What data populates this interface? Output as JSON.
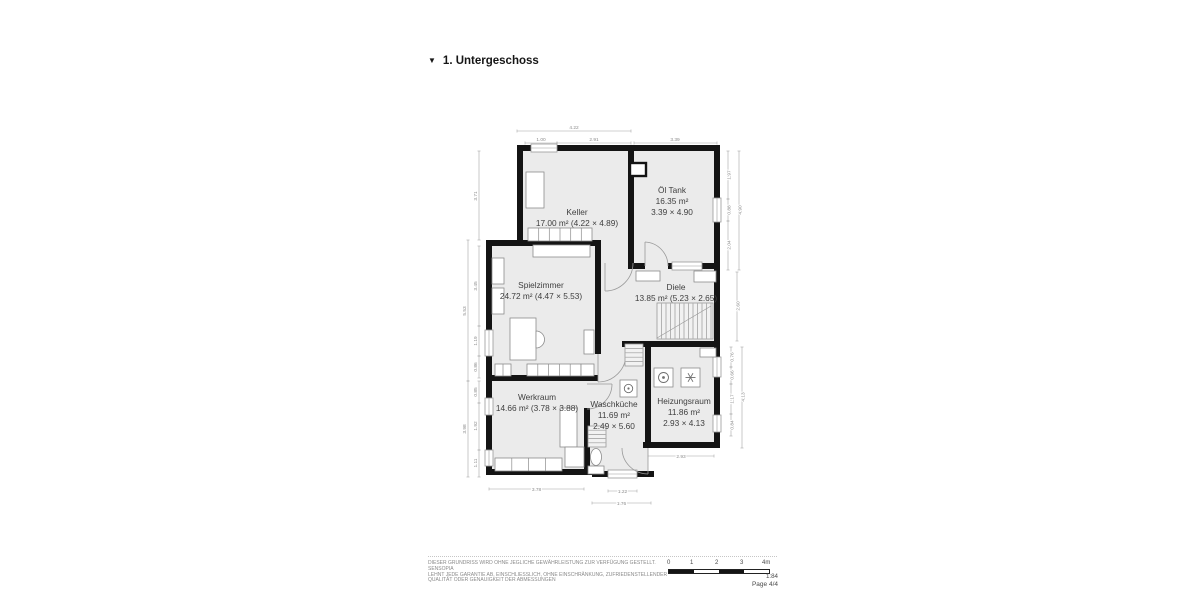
{
  "header": {
    "collapse_icon": "▼",
    "title": "1. Untergeschoss"
  },
  "rooms": {
    "keller": {
      "name": "Keller",
      "details": "17.00 m² (4.22 × 4.89)"
    },
    "oel_tank": {
      "name": "Öl Tank",
      "area": "16.35 m²",
      "size": "3.39 × 4.90"
    },
    "spielzimmer": {
      "name": "Spielzimmer",
      "details": "24.72 m² (4.47 × 5.53)"
    },
    "diele": {
      "name": "Diele",
      "details": "13.85 m² (5.23 × 2.65)"
    },
    "werkraum": {
      "name": "Werkraum",
      "details": "14.66 m² (3.78 × 3.88)"
    },
    "waschkueche": {
      "name": "Waschküche",
      "area": "11.69 m²",
      "size": "2.49 × 5.60"
    },
    "heizungsraum": {
      "name": "Heizungsraum",
      "area": "11.86 m²",
      "size": "2.93 × 4.13"
    }
  },
  "dimensions": {
    "top": {
      "overall": "4.22",
      "window": "1.00",
      "keller_rest": "2.91",
      "oel_tank": "3.39"
    },
    "left": {
      "keller": "3.71",
      "spielzimmer_overall": "5.53",
      "spielzimmer_a": "3.45",
      "spielzimmer_b": "1.19",
      "spielzimmer_c": "0.86",
      "werkraum_overall": "3.98",
      "werkraum_a": "0.85",
      "werkraum_b": "1.92",
      "werkraum_c": "1.11"
    },
    "right": {
      "oel_tank_overall": "4.90",
      "oel_tank_a": "1.97",
      "oel_tank_b": "0.88",
      "oel_tank_c": "2.04",
      "diele": "2.60",
      "heizungsraum_overall": "4.13",
      "heizungsraum_a": "0.76",
      "heizungsraum_b": "0.66",
      "heizungsraum_c": "1.17",
      "heizungsraum_d": "0.84"
    },
    "bottom": {
      "werkraum": "3.78",
      "waschkueche_window": "1.22",
      "waschkueche": "1.76",
      "heizungsraum": "2.93"
    }
  },
  "footer": {
    "disclaimer": [
      "DIESER GRUNDRISS WIRD OHNE JEGLICHE GEWÄHRLEISTUNG ZUR VERFÜGUNG GESTELLT. SENSOPIA",
      "LEHNT JEDE GARANTIE AB, EINSCHLIESSLICH, OHNE EINSCHRÄNKUNG, ZUFRIEDENSTELLENDER",
      "QUALITÄT ODER GENAUIGKEIT DER ABMESSUNGEN"
    ],
    "scale_ticks": [
      "0",
      "1",
      "2",
      "3",
      "4m"
    ],
    "scale_ratio": "1:84",
    "page": "Page 4/4"
  },
  "colors": {
    "wall": "#141414",
    "room_fill": "#ebebeb",
    "dimension": "#8c8c8c",
    "label": "#3e3e3e"
  }
}
